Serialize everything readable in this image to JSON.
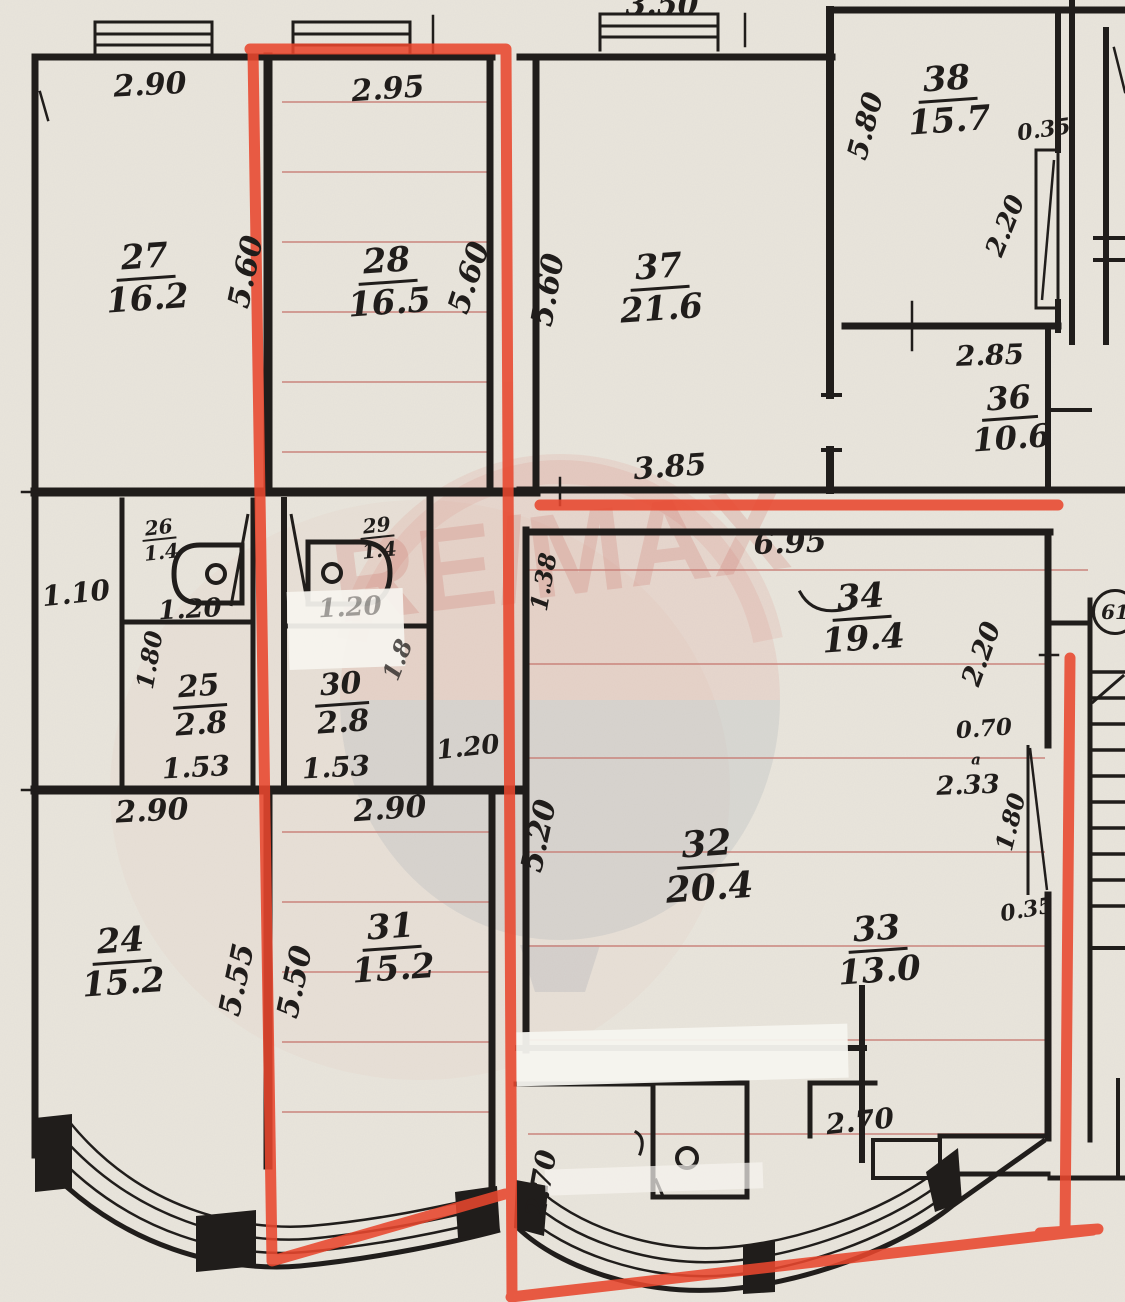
{
  "document": {
    "kind": "scanned apartment floor plan",
    "watermark": "RE/MAX",
    "colors": {
      "paper": "#e9e5dc",
      "ink": "#201d1b",
      "highlight_red": "#e8472e",
      "pencil_red": "#c97f77",
      "watermark_red": "#c34a40",
      "watermark_gray": "#8b98a6"
    }
  },
  "rooms": [
    {
      "number": "24",
      "area": "15.2"
    },
    {
      "number": "25",
      "area": "2.8"
    },
    {
      "number": "26",
      "area": "1.4"
    },
    {
      "number": "27",
      "area": "16.2"
    },
    {
      "number": "28",
      "area": "16.5"
    },
    {
      "number": "29",
      "area": "1.4"
    },
    {
      "number": "30",
      "area": "2.8"
    },
    {
      "number": "31",
      "area": "15.2"
    },
    {
      "number": "32",
      "area": "20.4"
    },
    {
      "number": "33",
      "area": "13.0"
    },
    {
      "number": "34",
      "area": "19.4"
    },
    {
      "number": "36",
      "area": "10.6"
    },
    {
      "number": "37",
      "area": "21.6"
    },
    {
      "number": "38",
      "area": "15.7"
    }
  ],
  "plan": {
    "labels": [
      {
        "name": "dim-window-37-width",
        "text": "3.50",
        "x": 662,
        "y": 6,
        "size": 30
      },
      {
        "name": "dim-room27-width",
        "text": "2.90",
        "x": 150,
        "y": 86,
        "size": 30,
        "rot": -3
      },
      {
        "name": "dim-room28-width",
        "text": "2.95",
        "x": 388,
        "y": 90,
        "size": 30,
        "rot": -4
      },
      {
        "name": "room-27-label",
        "text": "27",
        "area": "16.2",
        "x": 146,
        "y": 278,
        "size": 34,
        "rot": -4
      },
      {
        "name": "room-28-label",
        "text": "28",
        "area": "16.5",
        "x": 388,
        "y": 282,
        "size": 34,
        "rot": -4
      },
      {
        "name": "dim-room27-depth",
        "text": "5.60",
        "x": 247,
        "y": 272,
        "size": 30,
        "rot": -78
      },
      {
        "name": "dim-room28-depth",
        "text": "5.60",
        "x": 470,
        "y": 278,
        "size": 30,
        "rot": -72
      },
      {
        "name": "dim-room37-depth",
        "text": "5.60",
        "x": 549,
        "y": 290,
        "size": 30,
        "rot": -80
      },
      {
        "name": "room-37-label",
        "text": "37",
        "area": "21.6",
        "x": 660,
        "y": 288,
        "size": 34,
        "rot": -4
      },
      {
        "name": "dim-room37-width",
        "text": "3.85",
        "x": 670,
        "y": 468,
        "size": 30,
        "rot": -4
      },
      {
        "name": "room-38-label",
        "text": "38",
        "area": "15.7",
        "x": 948,
        "y": 100,
        "size": 34,
        "rot": -4
      },
      {
        "name": "dim-room38-depth",
        "text": "5.80",
        "x": 866,
        "y": 126,
        "size": 28,
        "rot": -75
      },
      {
        "name": "dim-room38-wall",
        "text": "0.35",
        "x": 1044,
        "y": 130,
        "size": 22,
        "rot": -8
      },
      {
        "name": "dim-room38-door",
        "text": "2.20",
        "x": 1006,
        "y": 226,
        "size": 26,
        "rot": -68
      },
      {
        "name": "dim-room36-width",
        "text": "2.85",
        "x": 990,
        "y": 356,
        "size": 28,
        "rot": -2
      },
      {
        "name": "room-36-label",
        "text": "36",
        "area": "10.6",
        "x": 1010,
        "y": 418,
        "size": 32,
        "rot": -4
      },
      {
        "name": "dim-hall-width",
        "text": "1.10",
        "x": 76,
        "y": 594,
        "size": 28,
        "rot": -6
      },
      {
        "name": "room-26-label",
        "text": "26",
        "area": "1.4",
        "x": 160,
        "y": 540,
        "size": 20,
        "rot": -6,
        "small": true
      },
      {
        "name": "dim-wc26-width",
        "text": "1.20",
        "x": 190,
        "y": 610,
        "size": 26,
        "rot": -3
      },
      {
        "name": "dim-room25-depth",
        "text": "1.80",
        "x": 150,
        "y": 660,
        "size": 24,
        "rot": -80
      },
      {
        "name": "room-25-label",
        "text": "25",
        "area": "2.8",
        "x": 200,
        "y": 706,
        "size": 30,
        "rot": -4
      },
      {
        "name": "dim-room25-width",
        "text": "1.53",
        "x": 196,
        "y": 768,
        "size": 28,
        "rot": -3
      },
      {
        "name": "room-29-label",
        "text": "29",
        "area": "1.4",
        "x": 378,
        "y": 538,
        "size": 20,
        "rot": -6,
        "small": true
      },
      {
        "name": "dim-wc29-width",
        "text": "1.20",
        "x": 350,
        "y": 608,
        "size": 26,
        "rot": -3,
        "op": 0.4
      },
      {
        "name": "room-30-label",
        "text": "30",
        "area": "2.8",
        "x": 342,
        "y": 704,
        "size": 30,
        "rot": -4
      },
      {
        "name": "dim-room30-depth",
        "text": "1.8",
        "x": 398,
        "y": 660,
        "size": 24,
        "rot": -68,
        "op": 0.75
      },
      {
        "name": "dim-room30-width",
        "text": "1.53",
        "x": 336,
        "y": 768,
        "size": 28,
        "rot": -3
      },
      {
        "name": "dim-corridor-width",
        "text": "1.20",
        "x": 468,
        "y": 748,
        "size": 26,
        "rot": -6
      },
      {
        "name": "dim-room24-width",
        "text": "2.90",
        "x": 152,
        "y": 812,
        "size": 30,
        "rot": -3
      },
      {
        "name": "dim-room31-width",
        "text": "2.90",
        "x": 390,
        "y": 810,
        "size": 30,
        "rot": -4
      },
      {
        "name": "room-24-label",
        "text": "24",
        "area": "15.2",
        "x": 122,
        "y": 962,
        "size": 34,
        "rot": -4
      },
      {
        "name": "dim-room24-depth",
        "text": "5.55",
        "x": 238,
        "y": 980,
        "size": 30,
        "rot": -78
      },
      {
        "name": "room-31-label",
        "text": "31",
        "area": "15.2",
        "x": 392,
        "y": 948,
        "size": 34,
        "rot": -4
      },
      {
        "name": "dim-room31-depth",
        "text": "5.50",
        "x": 296,
        "y": 982,
        "size": 30,
        "rot": -78
      },
      {
        "name": "dim-room34-width",
        "text": "6.95",
        "x": 790,
        "y": 544,
        "size": 30,
        "rot": -2
      },
      {
        "name": "dim-room34-left",
        "text": "1.38",
        "x": 544,
        "y": 582,
        "size": 24,
        "rot": -80
      },
      {
        "name": "room-34-label",
        "text": "34",
        "area": "19.4",
        "x": 862,
        "y": 618,
        "size": 34,
        "rot": -4
      },
      {
        "name": "dim-room34-right",
        "text": "2.20",
        "x": 982,
        "y": 654,
        "size": 27,
        "rot": -70
      },
      {
        "name": "dim-room33-top",
        "text": "0.70",
        "x": 984,
        "y": 729,
        "size": 23,
        "rot": -4
      },
      {
        "name": "door-mark-a",
        "text": "a",
        "x": 976,
        "y": 760,
        "size": 15
      },
      {
        "name": "dim-room33-closet",
        "text": "2.33",
        "x": 968,
        "y": 786,
        "size": 26,
        "rot": -2
      },
      {
        "name": "dim-room33-door",
        "text": "1.80",
        "x": 1011,
        "y": 822,
        "size": 24,
        "rot": -76
      },
      {
        "name": "dim-room33-wall",
        "text": "0.35",
        "x": 1027,
        "y": 910,
        "size": 22,
        "rot": -10
      },
      {
        "name": "room-32-label",
        "text": "32",
        "area": "20.4",
        "x": 708,
        "y": 866,
        "size": 36,
        "rot": -4
      },
      {
        "name": "dim-room32-depth",
        "text": "5.20",
        "x": 540,
        "y": 836,
        "size": 30,
        "rot": -78
      },
      {
        "name": "room-33-label",
        "text": "33",
        "area": "13.0",
        "x": 878,
        "y": 950,
        "size": 34,
        "rot": -4
      },
      {
        "name": "dim-room33-width",
        "text": "2.70",
        "x": 860,
        "y": 1122,
        "size": 28,
        "rot": -6
      },
      {
        "name": "dim-bay-depth",
        "text": "2.70",
        "x": 542,
        "y": 1184,
        "size": 28,
        "rot": -80
      },
      {
        "name": "plan-sheet-number",
        "text": "61",
        "x": 1115,
        "y": 612,
        "size": 20,
        "circled": true
      }
    ]
  }
}
